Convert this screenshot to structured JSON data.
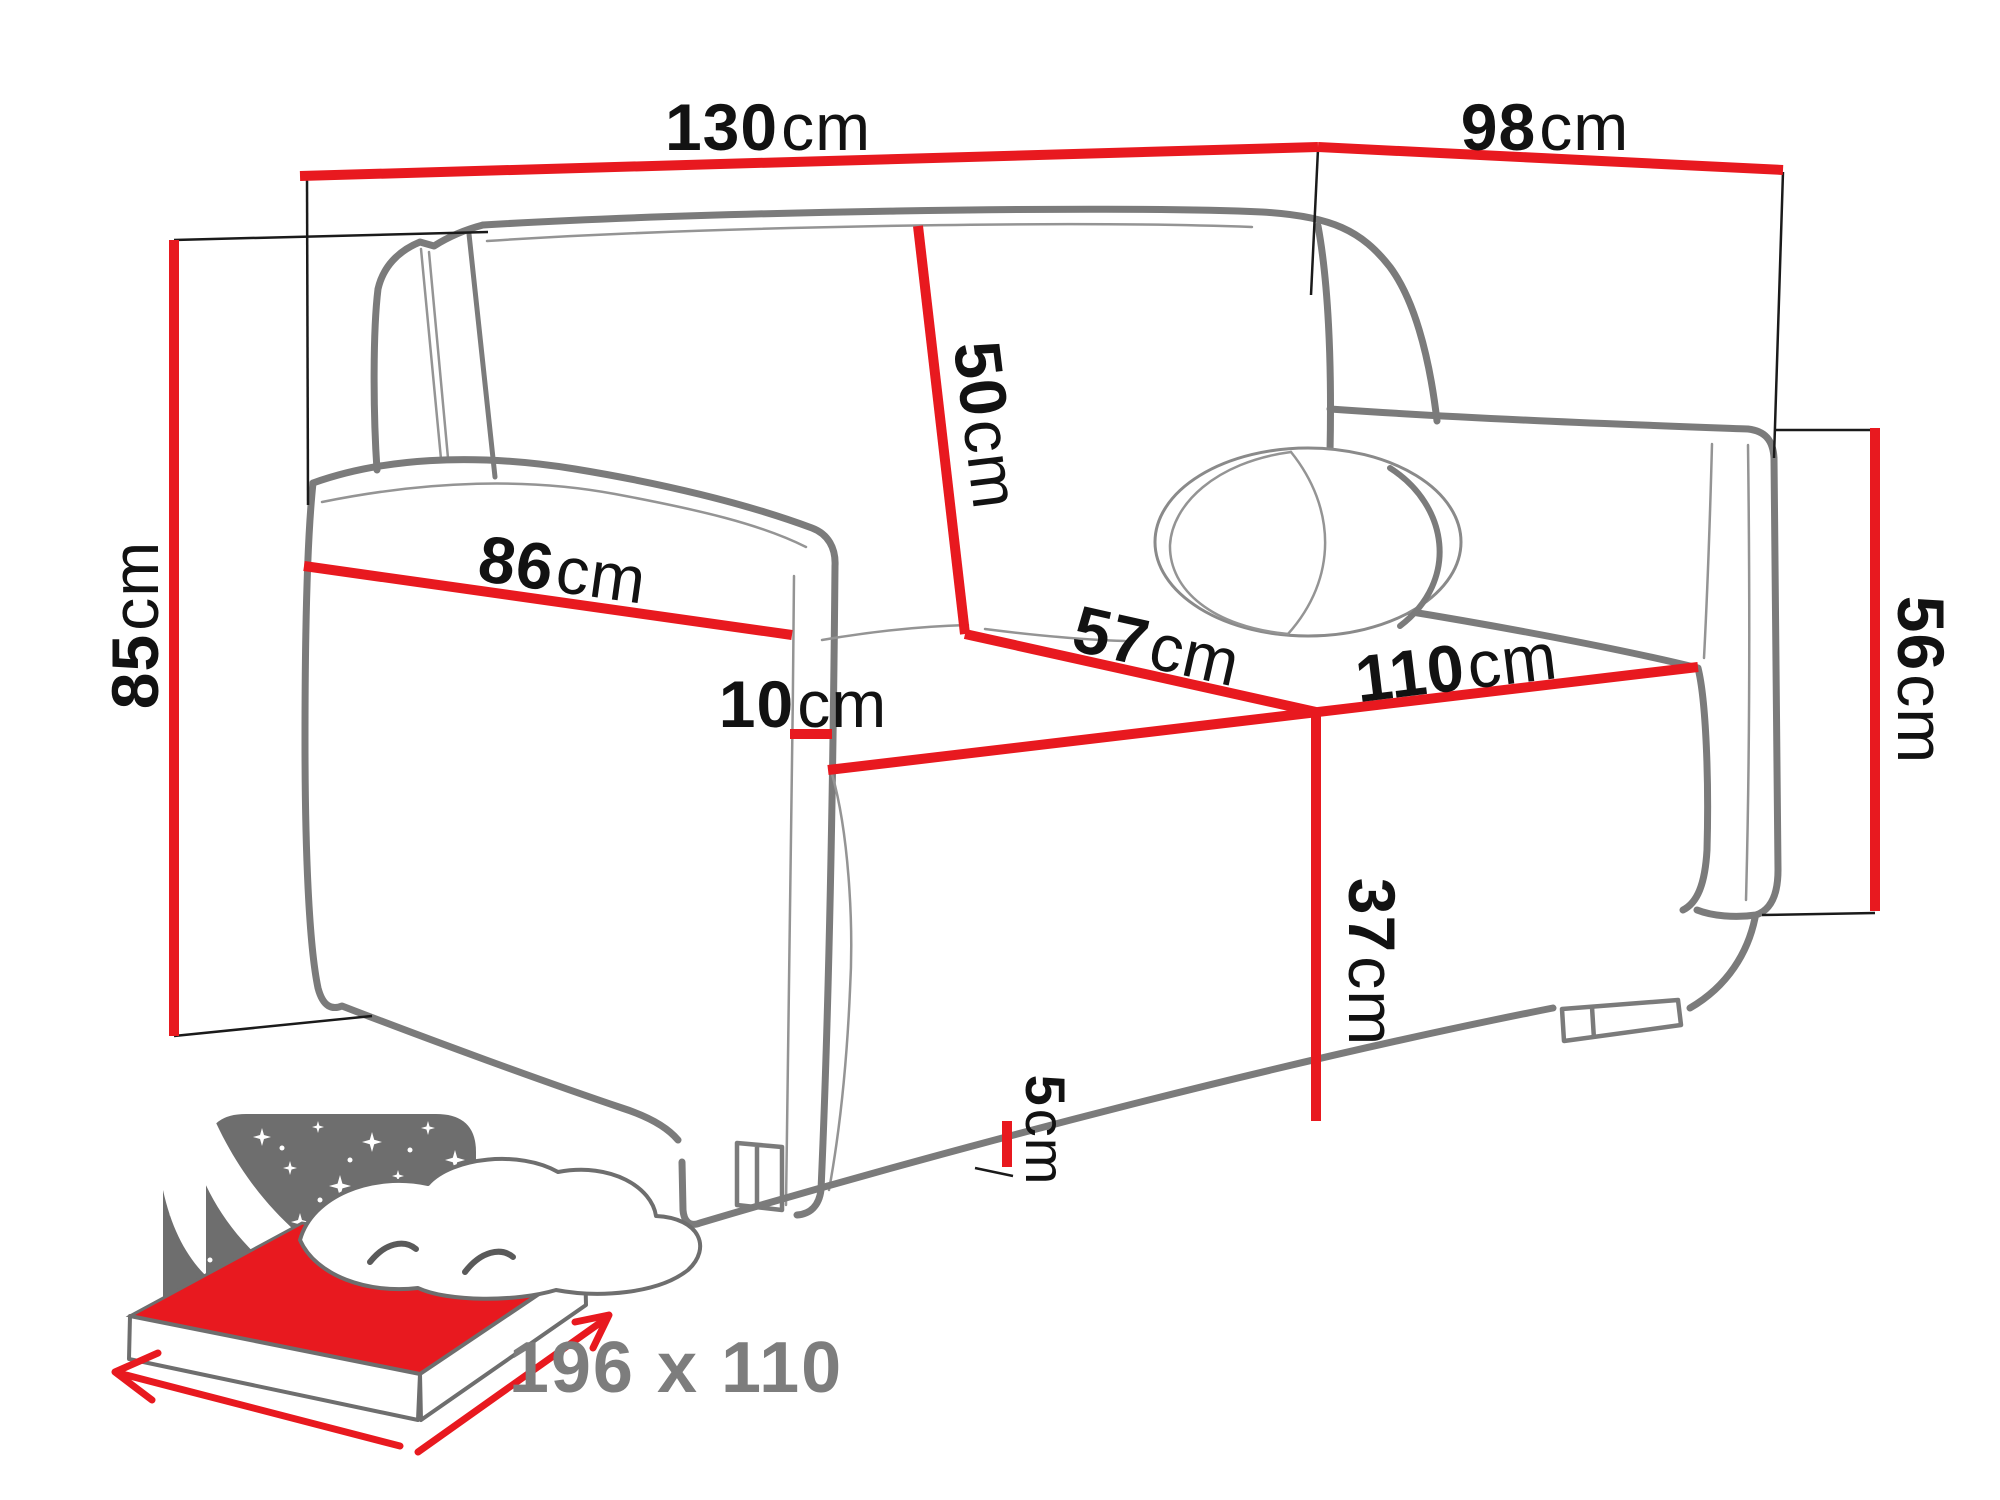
{
  "diagram": {
    "title": "sofa-bed dimensions diagram",
    "dimensions": {
      "width_top": {
        "value": "130",
        "unit": "cm"
      },
      "depth_top": {
        "value": "98",
        "unit": "cm"
      },
      "height_left": {
        "value": "85",
        "unit": "cm"
      },
      "backrest": {
        "value": "50",
        "unit": "cm"
      },
      "armrest_length": {
        "value": "86",
        "unit": "cm"
      },
      "armrest_width": {
        "value": "10",
        "unit": "cm"
      },
      "seat_depth": {
        "value": "57",
        "unit": "cm"
      },
      "seat_front": {
        "value": "110",
        "unit": "cm"
      },
      "seat_height": {
        "value": "37",
        "unit": "cm"
      },
      "arm_height": {
        "value": "56",
        "unit": "cm"
      },
      "leg_height": {
        "value": "5",
        "unit": "cm"
      }
    },
    "sleeping_area": {
      "label": "196 x 110"
    },
    "colors": {
      "dimension_red": "#e8191f",
      "outline_gray": "#7b7b7b",
      "label_black": "#121212",
      "icon_gray": "#6e6e6e",
      "size_text_gray": "#7d7d7d"
    }
  }
}
